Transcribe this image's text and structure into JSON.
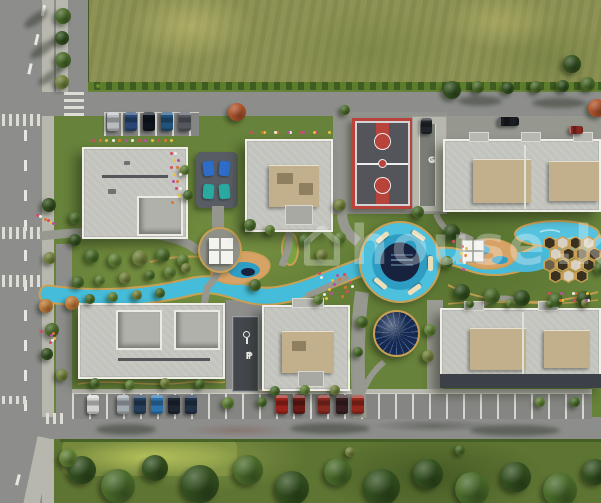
{
  "watermark": {
    "icon": "house-icon",
    "text": "house",
    "suffix": ".k",
    "color": "#ffffff",
    "opacity": 0.3
  },
  "markings": {
    "garage_label": "G",
    "garage_arrow": "↓",
    "parking_arrow": "↑",
    "parking_label": "P"
  },
  "palette": {
    "base": {
      "road": "#8d8e8c",
      "roadDark": "#858683",
      "sidewalk": "#b7b7ae",
      "lawn": "#67823a",
      "lawnTop": "#8e9254",
      "lawnBottom": "#5e7432",
      "hedge": "#3f5c22",
      "building": "#c7c8c2",
      "buildingEdge": "#efeee8",
      "roofUnit": "#c2b08d",
      "courtSurface": "#53555b",
      "courtRed": "#b8433a",
      "water": "#4cc0dd",
      "waterDark": "#17233e",
      "trackGold": "#c9a054",
      "sand": "#d7a265",
      "dome": "#16294e",
      "canopyWhite": "#f3f3ef",
      "rampDark": "#43464b"
    },
    "trees": {
      "dark": "#33501f",
      "mid": "#4a6b2a",
      "light": "#5f8034",
      "olive": "#72813c",
      "orange": "#c07a35",
      "rust": "#b0542b"
    },
    "hex": {
      "d": "#39301f",
      "l": "#d8d1c3",
      "m": "#6e6147"
    },
    "flowers": [
      "#d24b63",
      "#e8c23a",
      "#e0742e",
      "#efede6",
      "#b84fa0"
    ]
  },
  "scene": {
    "trees": [
      {
        "x": 63,
        "y": 16,
        "r": 8,
        "c": "mid"
      },
      {
        "x": 62,
        "y": 38,
        "r": 7,
        "c": "dark"
      },
      {
        "x": 63,
        "y": 60,
        "r": 8,
        "c": "mid"
      },
      {
        "x": 62,
        "y": 82,
        "r": 7,
        "c": "olive"
      },
      {
        "x": 49,
        "y": 205,
        "r": 7,
        "c": "dark"
      },
      {
        "x": 75,
        "y": 218,
        "r": 6,
        "c": "mid"
      },
      {
        "x": 50,
        "y": 258,
        "r": 6,
        "c": "olive"
      },
      {
        "x": 46,
        "y": 306,
        "r": 7,
        "c": "orange"
      },
      {
        "x": 52,
        "y": 330,
        "r": 7,
        "c": "mid"
      },
      {
        "x": 47,
        "y": 354,
        "r": 6,
        "c": "dark"
      },
      {
        "x": 62,
        "y": 375,
        "r": 6,
        "c": "olive"
      },
      {
        "x": 452,
        "y": 90,
        "r": 9,
        "c": "dark"
      },
      {
        "x": 478,
        "y": 87,
        "r": 6,
        "c": "mid"
      },
      {
        "x": 508,
        "y": 88,
        "r": 6,
        "c": "dark"
      },
      {
        "x": 536,
        "y": 87,
        "r": 6,
        "c": "mid"
      },
      {
        "x": 563,
        "y": 86,
        "r": 6,
        "c": "dark"
      },
      {
        "x": 588,
        "y": 84,
        "r": 7,
        "c": "mid"
      },
      {
        "x": 597,
        "y": 108,
        "r": 9,
        "c": "rust"
      },
      {
        "x": 572,
        "y": 64,
        "r": 9,
        "c": "dark"
      },
      {
        "x": 237,
        "y": 112,
        "r": 9,
        "c": "rust"
      },
      {
        "x": 345,
        "y": 110,
        "r": 5,
        "c": "mid"
      },
      {
        "x": 92,
        "y": 256,
        "r": 7,
        "c": "mid"
      },
      {
        "x": 115,
        "y": 260,
        "r": 7,
        "c": "light"
      },
      {
        "x": 140,
        "y": 258,
        "r": 8,
        "c": "olive"
      },
      {
        "x": 163,
        "y": 255,
        "r": 7,
        "c": "mid"
      },
      {
        "x": 183,
        "y": 260,
        "r": 6,
        "c": "light"
      },
      {
        "x": 75,
        "y": 240,
        "r": 6,
        "c": "dark"
      },
      {
        "x": 72,
        "y": 303,
        "r": 7,
        "c": "orange"
      },
      {
        "x": 90,
        "y": 299,
        "r": 5,
        "c": "mid"
      },
      {
        "x": 113,
        "y": 297,
        "r": 5,
        "c": "light"
      },
      {
        "x": 137,
        "y": 295,
        "r": 5,
        "c": "olive"
      },
      {
        "x": 160,
        "y": 293,
        "r": 5,
        "c": "mid"
      },
      {
        "x": 78,
        "y": 282,
        "r": 6,
        "c": "mid"
      },
      {
        "x": 100,
        "y": 280,
        "r": 5,
        "c": "light"
      },
      {
        "x": 125,
        "y": 278,
        "r": 6,
        "c": "olive"
      },
      {
        "x": 150,
        "y": 275,
        "r": 5,
        "c": "mid"
      },
      {
        "x": 170,
        "y": 272,
        "r": 6,
        "c": "light"
      },
      {
        "x": 186,
        "y": 268,
        "r": 5,
        "c": "olive"
      },
      {
        "x": 250,
        "y": 225,
        "r": 6,
        "c": "mid"
      },
      {
        "x": 270,
        "y": 230,
        "r": 5,
        "c": "light"
      },
      {
        "x": 305,
        "y": 240,
        "r": 6,
        "c": "mid"
      },
      {
        "x": 322,
        "y": 255,
        "r": 6,
        "c": "olive"
      },
      {
        "x": 340,
        "y": 238,
        "r": 6,
        "c": "light"
      },
      {
        "x": 255,
        "y": 285,
        "r": 6,
        "c": "mid"
      },
      {
        "x": 318,
        "y": 300,
        "r": 5,
        "c": "light"
      },
      {
        "x": 340,
        "y": 205,
        "r": 6,
        "c": "olive"
      },
      {
        "x": 185,
        "y": 170,
        "r": 5,
        "c": "light"
      },
      {
        "x": 188,
        "y": 195,
        "r": 5,
        "c": "mid"
      },
      {
        "x": 452,
        "y": 232,
        "r": 8,
        "c": "dark"
      },
      {
        "x": 447,
        "y": 262,
        "r": 6,
        "c": "mid"
      },
      {
        "x": 462,
        "y": 292,
        "r": 8,
        "c": "dark"
      },
      {
        "x": 492,
        "y": 296,
        "r": 8,
        "c": "mid"
      },
      {
        "x": 522,
        "y": 298,
        "r": 8,
        "c": "dark"
      },
      {
        "x": 556,
        "y": 300,
        "r": 7,
        "c": "mid"
      },
      {
        "x": 584,
        "y": 298,
        "r": 7,
        "c": "dark"
      },
      {
        "x": 600,
        "y": 268,
        "r": 6,
        "c": "mid"
      },
      {
        "x": 362,
        "y": 322,
        "r": 6,
        "c": "mid"
      },
      {
        "x": 430,
        "y": 330,
        "r": 6,
        "c": "light"
      },
      {
        "x": 428,
        "y": 356,
        "r": 6,
        "c": "olive"
      },
      {
        "x": 358,
        "y": 352,
        "r": 5,
        "c": "mid"
      },
      {
        "x": 418,
        "y": 212,
        "r": 6,
        "c": "mid"
      },
      {
        "x": 95,
        "y": 383,
        "r": 5,
        "c": "mid"
      },
      {
        "x": 130,
        "y": 385,
        "r": 5,
        "c": "light"
      },
      {
        "x": 165,
        "y": 383,
        "r": 5,
        "c": "olive"
      },
      {
        "x": 200,
        "y": 384,
        "r": 5,
        "c": "mid"
      },
      {
        "x": 275,
        "y": 391,
        "r": 5,
        "c": "mid"
      },
      {
        "x": 305,
        "y": 390,
        "r": 5,
        "c": "light"
      },
      {
        "x": 335,
        "y": 390,
        "r": 5,
        "c": "olive"
      },
      {
        "x": 470,
        "y": 304,
        "r": 4,
        "c": "mid"
      },
      {
        "x": 510,
        "y": 303,
        "r": 4,
        "c": "light"
      },
      {
        "x": 550,
        "y": 304,
        "r": 4,
        "c": "mid"
      },
      {
        "x": 585,
        "y": 303,
        "r": 4,
        "c": "olive"
      },
      {
        "x": 228,
        "y": 403,
        "r": 6,
        "c": "light"
      },
      {
        "x": 262,
        "y": 402,
        "r": 5,
        "c": "mid"
      },
      {
        "x": 540,
        "y": 402,
        "r": 5,
        "c": "light"
      },
      {
        "x": 575,
        "y": 402,
        "r": 5,
        "c": "mid"
      },
      {
        "x": 82,
        "y": 470,
        "r": 14,
        "c": "dark"
      },
      {
        "x": 118,
        "y": 486,
        "r": 17,
        "c": "mid"
      },
      {
        "x": 155,
        "y": 468,
        "r": 13,
        "c": "dark"
      },
      {
        "x": 200,
        "y": 484,
        "r": 19,
        "c": "dark"
      },
      {
        "x": 248,
        "y": 470,
        "r": 15,
        "c": "mid"
      },
      {
        "x": 292,
        "y": 488,
        "r": 17,
        "c": "dark"
      },
      {
        "x": 338,
        "y": 472,
        "r": 14,
        "c": "mid"
      },
      {
        "x": 382,
        "y": 487,
        "r": 18,
        "c": "dark"
      },
      {
        "x": 428,
        "y": 474,
        "r": 15,
        "c": "dark"
      },
      {
        "x": 472,
        "y": 489,
        "r": 17,
        "c": "mid"
      },
      {
        "x": 516,
        "y": 477,
        "r": 15,
        "c": "dark"
      },
      {
        "x": 560,
        "y": 490,
        "r": 17,
        "c": "mid"
      },
      {
        "x": 595,
        "y": 472,
        "r": 13,
        "c": "dark"
      },
      {
        "x": 68,
        "y": 458,
        "r": 9,
        "c": "light"
      },
      {
        "x": 350,
        "y": 452,
        "r": 5,
        "c": "olive"
      },
      {
        "x": 460,
        "y": 450,
        "r": 5,
        "c": "mid"
      }
    ],
    "cars": [
      {
        "x": 107,
        "y": 112,
        "w": 12,
        "h": 19,
        "c": "#c2c6c9"
      },
      {
        "x": 125,
        "y": 112,
        "w": 12,
        "h": 19,
        "c": "#2b4a7a"
      },
      {
        "x": 143,
        "y": 112,
        "w": 12,
        "h": 19,
        "c": "#10161f"
      },
      {
        "x": 161,
        "y": 112,
        "w": 12,
        "h": 19,
        "c": "#23567f"
      },
      {
        "x": 179,
        "y": 112,
        "w": 12,
        "h": 19,
        "c": "#585d63"
      },
      {
        "x": 498,
        "y": 117,
        "w": 21,
        "h": 9,
        "c": "#1a1d22"
      },
      {
        "x": 569,
        "y": 126,
        "w": 14,
        "h": 8,
        "c": "#8e2b23"
      },
      {
        "x": 421,
        "y": 118,
        "w": 11,
        "h": 16,
        "c": "#23262b"
      },
      {
        "x": 87,
        "y": 395,
        "w": 12,
        "h": 19,
        "c": "#dcdcd8"
      },
      {
        "x": 117,
        "y": 395,
        "w": 12,
        "h": 19,
        "c": "#aab3ba"
      },
      {
        "x": 134,
        "y": 395,
        "w": 12,
        "h": 19,
        "c": "#27415f"
      },
      {
        "x": 151,
        "y": 395,
        "w": 12,
        "h": 19,
        "c": "#2e78b5"
      },
      {
        "x": 168,
        "y": 395,
        "w": 12,
        "h": 19,
        "c": "#1d2733"
      },
      {
        "x": 185,
        "y": 395,
        "w": 12,
        "h": 19,
        "c": "#24344a"
      },
      {
        "x": 276,
        "y": 395,
        "w": 12,
        "h": 19,
        "c": "#a3241c"
      },
      {
        "x": 293,
        "y": 395,
        "w": 12,
        "h": 19,
        "c": "#6e1b16"
      },
      {
        "x": 318,
        "y": 395,
        "w": 12,
        "h": 19,
        "c": "#8e2b23"
      },
      {
        "x": 336,
        "y": 395,
        "w": 12,
        "h": 19,
        "c": "#3a1f22"
      },
      {
        "x": 352,
        "y": 395,
        "w": 12,
        "h": 19,
        "c": "#9c2a20"
      }
    ],
    "shadows": [
      {
        "x": 22,
        "y": 14,
        "w": 28,
        "h": 10,
        "rot": -35
      },
      {
        "x": 28,
        "y": 44,
        "w": 30,
        "h": 10,
        "rot": -35
      },
      {
        "x": 36,
        "y": 72,
        "w": 28,
        "h": 9,
        "rot": -35
      },
      {
        "x": 458,
        "y": 96,
        "w": 44,
        "h": 10,
        "rot": 0
      },
      {
        "x": 532,
        "y": 98,
        "w": 54,
        "h": 10,
        "rot": 0
      },
      {
        "x": 96,
        "y": 424,
        "w": 60,
        "h": 11,
        "rot": 0
      },
      {
        "x": 290,
        "y": 423,
        "w": 80,
        "h": 11,
        "rot": 0
      },
      {
        "x": 470,
        "y": 425,
        "w": 90,
        "h": 11,
        "rot": 0
      }
    ],
    "flower_clusters": [
      {
        "x": 170,
        "y": 152,
        "w": 10,
        "h": 56,
        "n": 14
      },
      {
        "x": 318,
        "y": 272,
        "w": 34,
        "h": 26,
        "n": 16
      },
      {
        "x": 92,
        "y": 139,
        "w": 84,
        "h": 7,
        "n": 13
      },
      {
        "x": 250,
        "y": 131,
        "w": 80,
        "h": 7,
        "n": 12
      },
      {
        "x": 36,
        "y": 214,
        "w": 18,
        "h": 10,
        "n": 6
      },
      {
        "x": 40,
        "y": 330,
        "w": 14,
        "h": 12,
        "n": 6
      },
      {
        "x": 548,
        "y": 292,
        "w": 40,
        "h": 14,
        "n": 10
      },
      {
        "x": 452,
        "y": 240,
        "w": 14,
        "h": 30,
        "n": 8
      }
    ],
    "hex_cells": [
      {
        "x": 3,
        "y": 0,
        "c": "d"
      },
      {
        "x": 16,
        "y": 0,
        "c": "l"
      },
      {
        "x": 29,
        "y": 0,
        "c": "d"
      },
      {
        "x": 42,
        "y": 0,
        "c": "l"
      },
      {
        "x": 9,
        "y": 11,
        "c": "l"
      },
      {
        "x": 22,
        "y": 11,
        "c": "d"
      },
      {
        "x": 35,
        "y": 11,
        "c": "m"
      },
      {
        "x": 48,
        "y": 11,
        "c": "d"
      },
      {
        "x": 3,
        "y": 22,
        "c": "m"
      },
      {
        "x": 16,
        "y": 22,
        "c": "d"
      },
      {
        "x": 29,
        "y": 22,
        "c": "l"
      },
      {
        "x": 42,
        "y": 22,
        "c": "d"
      },
      {
        "x": 9,
        "y": 33,
        "c": "d"
      },
      {
        "x": 22,
        "y": 33,
        "c": "l"
      },
      {
        "x": 35,
        "y": 33,
        "c": "d"
      }
    ]
  }
}
